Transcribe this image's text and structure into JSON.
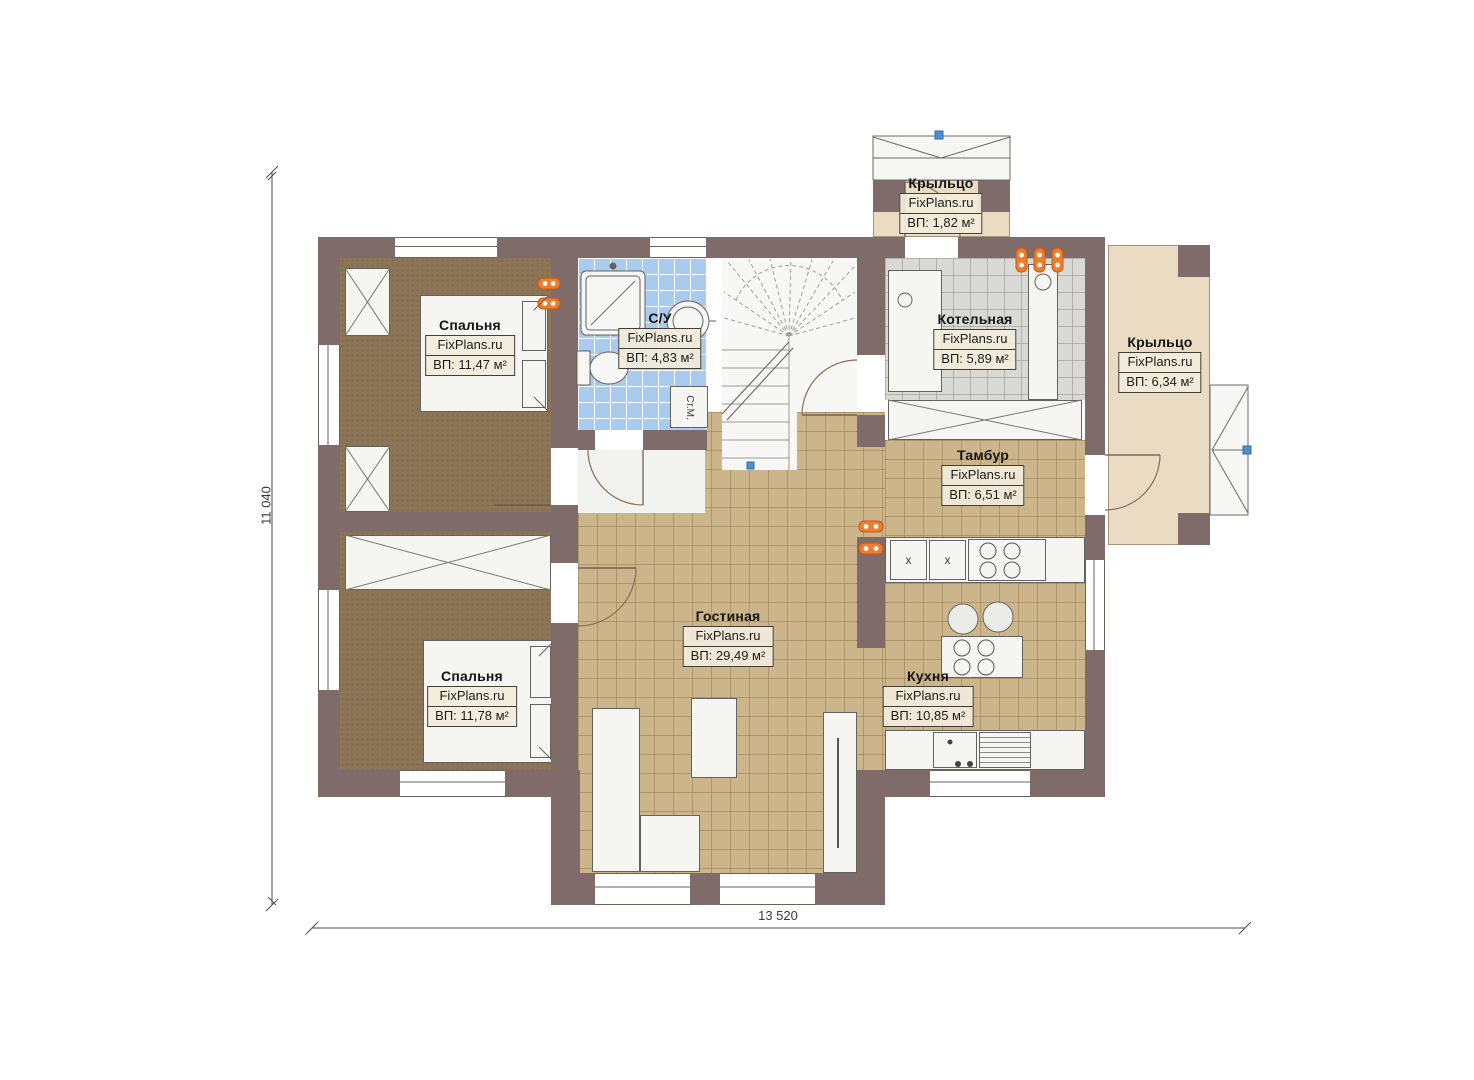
{
  "watermark": "FixPlans.ru",
  "dimensions": {
    "horizontal": "13 520",
    "vertical": "11 040"
  },
  "rooms": [
    {
      "id": "bedroom-1",
      "name": "Спальня",
      "area": "ВП: 11,47 м²"
    },
    {
      "id": "bathroom",
      "name": "С/У",
      "area": "ВП: 4,83 м²"
    },
    {
      "id": "boiler-room",
      "name": "Котельная",
      "area": "ВП: 5,89 м²"
    },
    {
      "id": "porch-top",
      "name": "Крыльцо",
      "area": "ВП: 1,82 м²"
    },
    {
      "id": "porch-right",
      "name": "Крыльцо",
      "area": "ВП: 6,34 м²"
    },
    {
      "id": "vestibule",
      "name": "Тамбур",
      "area": "ВП: 6,51 м²"
    },
    {
      "id": "living-room",
      "name": "Гостиная",
      "area": "ВП: 29,49 м²"
    },
    {
      "id": "bedroom-2",
      "name": "Спальня",
      "area": "ВП: 11,78 м²"
    },
    {
      "id": "kitchen",
      "name": "Кухня",
      "area": "ВП: 10,85 м²"
    }
  ],
  "fixtures": {
    "washing_machine": "Ст.М.",
    "cabinet_mark": "x"
  },
  "colors": {
    "wall": "#7e6b6a",
    "tile_tan": "#ccb48b",
    "tile_blue": "#a9cbf0",
    "tile_gray": "#d9d9d6",
    "carpet": "#8c7456",
    "porch": "#e9dcc3",
    "radiator": "#ef7d2b",
    "marker": "#4e8fd0"
  }
}
